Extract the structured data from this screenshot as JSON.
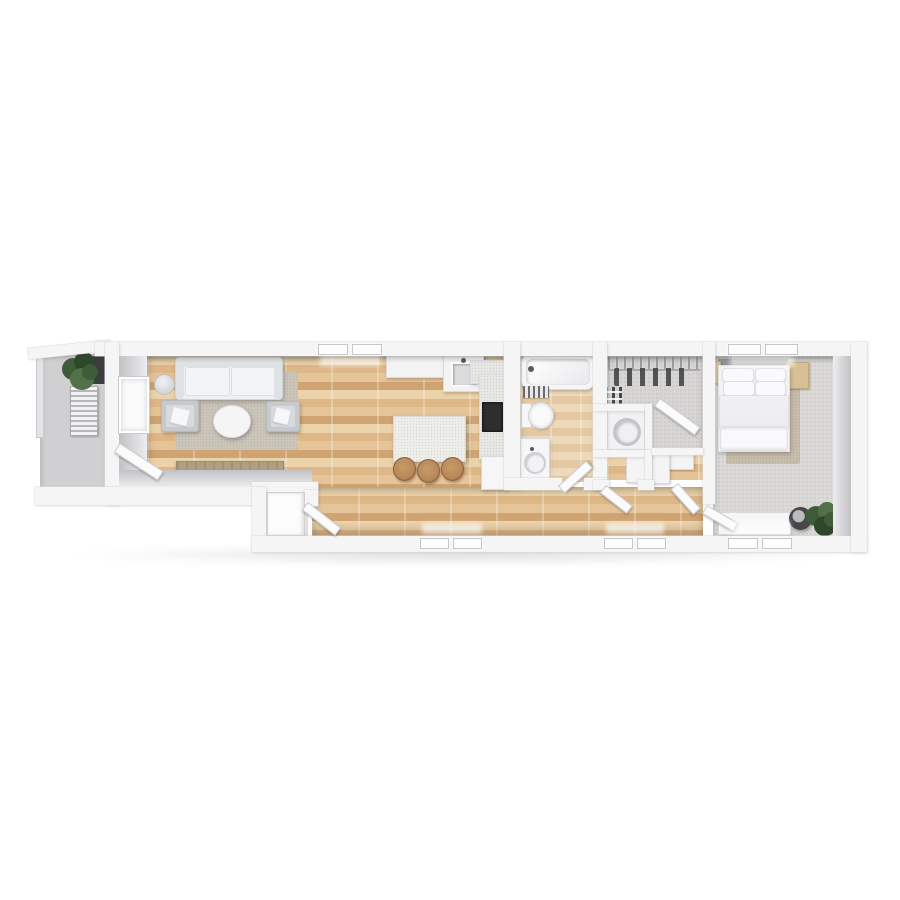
{
  "scene": {
    "type": "3d-floor-plan-render",
    "description": "Top-down 3D render of a long, narrow one-bedroom apartment on a white background",
    "background_color": "#ffffff"
  },
  "palette": {
    "wall": "#f5f5f6",
    "wall_edge": "#dcdcdf",
    "face_dark": "#c2c2c6",
    "face_light": "#ededef",
    "wood_a": "#ecd2a9",
    "wood_b": "#ddb787",
    "wood_c": "#e5c497",
    "wood_d": "#cfa472",
    "wood_seam": "rgba(255,255,255,.28)",
    "bath_a": "#eed9bb",
    "bath_b": "#e2c8a3",
    "balcony": "#d0d0d2",
    "carpet": "#d7d6d4",
    "carpet_bed": "#dcdad7",
    "rug_living": "#ccc6bb",
    "rug_bed": "#c8beac",
    "sofa": "#edeff1",
    "sofa_shade": "#dfe2e4",
    "chair": "#c7cacc",
    "white_furn": "#f6f6f8",
    "island": "#ededea",
    "stool": "#b8895a",
    "console": "#b0a083",
    "dark": "#2e2e30",
    "plant": "#3f5c39",
    "plant_dark": "#2e4629",
    "nightstand": "#d8bf95",
    "headboard": "#96969a",
    "metal": "#9b9b9e"
  },
  "rooms": [
    {
      "id": "balcony",
      "label": "Balcony",
      "floor": "concrete",
      "furniture": [
        "potted-plant",
        "slatted-lounger",
        "storage-box"
      ]
    },
    {
      "id": "living-room",
      "label": "Living Room",
      "floor": "wood-plank",
      "furniture": [
        "sofa",
        "area-rug",
        "round-coffee-table",
        "armchair-left",
        "armchair-right",
        "floor-lamp",
        "media-console",
        "tv",
        "wall-window"
      ]
    },
    {
      "id": "kitchen",
      "label": "Kitchen",
      "floor": "wood-plank",
      "furniture": [
        "counter-run",
        "sink",
        "corner-counter",
        "kitchen-island",
        "bar-stools",
        "cooktop",
        "fridge"
      ],
      "bar_stool_count": 3
    },
    {
      "id": "entry",
      "label": "Entry",
      "floor": "tile",
      "furniture": [
        "front-door"
      ]
    },
    {
      "id": "hallway",
      "label": "Hallway",
      "floor": "wood-plank",
      "furniture": []
    },
    {
      "id": "bathroom",
      "label": "Bathroom",
      "floor": "wood-tile",
      "furniture": [
        "bathtub",
        "bath-mat",
        "toilet",
        "vanity-sink"
      ]
    },
    {
      "id": "walk-in-closet",
      "label": "Walk-in Closet",
      "floor": "carpet",
      "furniture": [
        "wire-shelf",
        "hanging-clothes",
        "shoe-shelves"
      ]
    },
    {
      "id": "laundry-niche",
      "label": "Laundry Niche",
      "floor": "tile",
      "furniture": [
        "washing-machine"
      ]
    },
    {
      "id": "storage",
      "label": "Storage",
      "floor": "wood-plank",
      "furniture": [
        "built-in-cabinets",
        "side-cabinet"
      ]
    },
    {
      "id": "bedroom",
      "label": "Bedroom",
      "floor": "carpet",
      "furniture": [
        "double-bed",
        "headboard",
        "nightstand-left",
        "nightstand-right",
        "area-rug",
        "dresser-bench",
        "round-stool",
        "potted-plant"
      ],
      "pillow_count": 4
    }
  ],
  "openings": {
    "windows": [
      {
        "wall": "top",
        "room": "living-room"
      },
      {
        "wall": "top",
        "room": "bedroom"
      },
      {
        "wall": "bottom",
        "room": "hallway-west"
      },
      {
        "wall": "bottom",
        "room": "hallway-east"
      },
      {
        "wall": "bottom",
        "room": "bedroom"
      }
    ],
    "doors": [
      {
        "room": "balcony",
        "state": "open"
      },
      {
        "room": "entry",
        "state": "open"
      },
      {
        "room": "bathroom",
        "state": "open"
      },
      {
        "room": "walk-in-closet",
        "state": "open"
      },
      {
        "room": "storage",
        "state": "open"
      },
      {
        "room": "laundry-niche",
        "state": "open"
      },
      {
        "room": "bedroom",
        "state": "open"
      }
    ]
  }
}
